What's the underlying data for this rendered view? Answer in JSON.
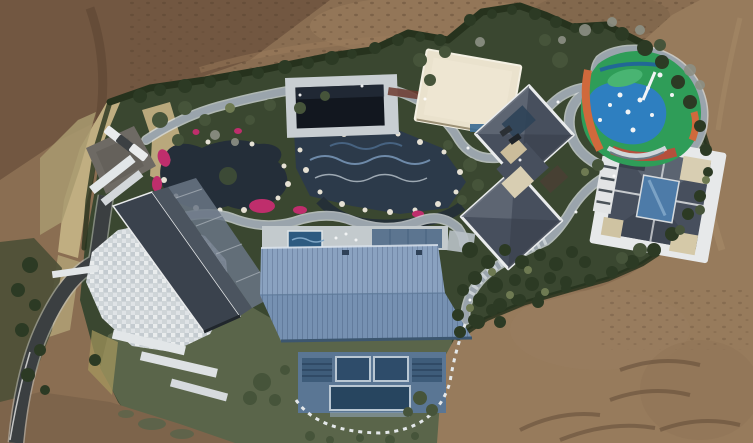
{
  "scene": {
    "description": "Aerial drone photograph of a landscaped private estate compound with ornamental ponds, winding stone paths, a painted playground, and several villas, surrounded by bare graded earth",
    "palette": {
      "dirt_base": "#8a6e52",
      "dirt_shadow": "#6d543e",
      "dirt_dark_streak": "#58422f",
      "dirt_right": "#977b5c",
      "dirt_bottom_left": "#7d644b",
      "dirt_ripple": "#5e4835",
      "dirt_light_streak": "#a98d6a",
      "dry_grass": "#c0ae81",
      "scrub_dark": "#4b4f36",
      "garden_green": "#3a4730",
      "lawn_green": "#5a654a",
      "hedge_green": "#26321d",
      "tree_dark": "#2c3a24",
      "tree_mid": "#46543a",
      "tree_olive": "#6e7a52",
      "tree_bare": "#8d9085",
      "pond_water": "#242e39",
      "mosaic_pool": "#2c3a4a",
      "plunge_pool": "#2d5a80",
      "flower_pink": "#bf2e6c",
      "path_gray": "#9aa4ac",
      "path_casing": "#d8dde0",
      "stone_white": "#e2e6e8",
      "courtyard_stone": "#cfd5d8",
      "road_asphalt": "#3b3f41",
      "roof_blue_light": "#8aa2c0",
      "roof_blue": "#7691b2",
      "facade_blue": "#5a7694",
      "window_glass": "#2e4c6a",
      "roof_slate": "#474f5d",
      "roof_slate_light": "#5f6774",
      "ridge_white": "#e9ebec",
      "roof_cream": "#eae2cd",
      "roof_dark_left": "#3a424d",
      "glass_roof": "#6a7685",
      "pavilion_dark": "#12171f",
      "terrace_cream": "#d8ceb2",
      "atrium_glass": "#4d7ba8",
      "play_green": "#2f9d58",
      "play_blue": "#2e7fc0",
      "play_navy": "#1f5fa0",
      "play_orange": "#d0693c",
      "play_rust": "#b5503c",
      "car_white": "#e9ebec",
      "car_dark": "#3c4043"
    },
    "inventory": {
      "parked_cars_west_lot": 3,
      "parked_cars_middle_villa": 2,
      "buildings": [
        "west villa with dark gable roof, glass roof section and white stone courtyard",
        "central hall with blue standing-seam metal roof and glazed facade",
        "middle villa with cross-shaped slate hip roof and white parapets",
        "east villa with slate hip roof around central glass atrium",
        "north pavilion with flat cream roof",
        "dark flat-roofed pool pavilion over mosaic water garden"
      ],
      "landscape_features": [
        "ornamental koi ponds with white boulder edging",
        "pink azalea flower beds",
        "winding gray stone paths with white curbing",
        "colorful painted playground (green, blue, orange)",
        "clipped hedge boundary",
        "asphalt driveway from south-west corner",
        "graded bare earth construction ground",
        "dirt access road along east edge"
      ]
    }
  }
}
